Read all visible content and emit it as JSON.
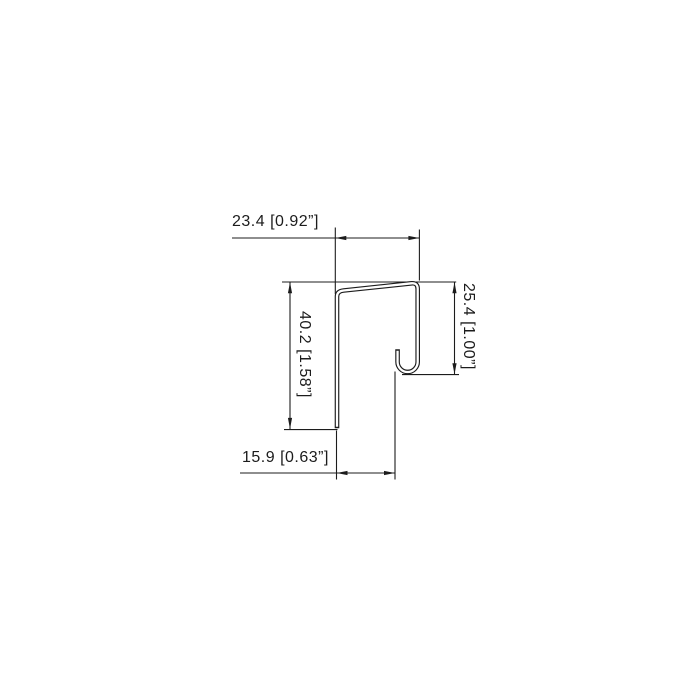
{
  "drawing": {
    "type": "profile-cross-section-technical-drawing",
    "background": "#ffffff",
    "line_color": "#1c1c1c",
    "dimensions": {
      "top_width": {
        "mm": "23.4",
        "inch": "0.92",
        "label": "23.4 [0.92”]"
      },
      "left_height": {
        "mm": "40.2",
        "inch": "1.58",
        "label": "40.2 [1.58”]"
      },
      "right_height": {
        "mm": "25.4",
        "inch": "1.00",
        "label": "25.4 [1.00”]"
      },
      "bottom_width": {
        "mm": "15.9",
        "inch": "0.63",
        "label": "15.9 [0.63”]"
      }
    }
  }
}
